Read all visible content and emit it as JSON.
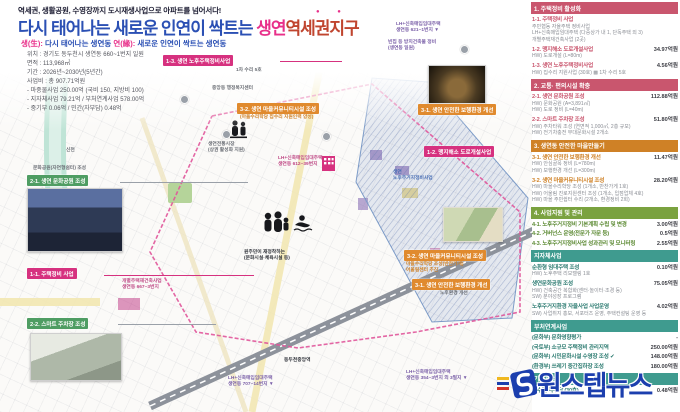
{
  "colors": {
    "title_blue": "#2b50b4",
    "title_pink": "#e8308a",
    "title_red": "#c0452f",
    "label_pink": "#d6317f",
    "label_orange": "#e08a2e",
    "label_green": "#4f9d63",
    "header_pink": "#c9566e",
    "header_orange": "#cf8126",
    "header_green": "#7aa23f",
    "header_teal": "#3f9b8f",
    "watermark_blue": "#1c3fae",
    "zone_blue": "#7d9cc8",
    "boundary_pink": "#e0559a"
  },
  "header": {
    "tagline": "역세권, 생활공원, 수영장까지 도시재생사업으로 아파트를 넘어서다!",
    "title_blue": "다시 태어나는 새로운 인연이 싹트는 ",
    "title_pink": "생연",
    "title_red": "역세권지구",
    "emphasis_dots": "● ●",
    "sub_saeng_label": "생(生):",
    "sub_saeng_text": " 다시 태어나는 생연동   ",
    "sub_yeon_label": "연(緣):",
    "sub_yeon_text": " 새로운 인연이 싹트는 생연동",
    "info": "위치 : 경기도 동두천시 생연동 660~1번지 일원\n면적 : 113,968㎡\n기간 : 2026년~2030년(5년간)\n사업비 : 총 907.71억원\n- 마중물사업 250.00억 (국비 150, 지방비 100)\n- 지자체사업 79.21억 / 부처연계사업 578.00억\n- 중기부 0.06억 / 민간(자부담) 0.48억"
  },
  "map": {
    "label_1_3": "1-3. 생연 노후주택정비사업",
    "label_1_3_sub": "1차 수리 5호",
    "admin_center": "중앙동 행정복지센터",
    "label_3_2_top": "3-2. 생연 마을커뮤니티시설 조성",
    "label_3_2_top_sub": "(마을수리학당 집수리 지원인력 양성)",
    "label_3_1_photo": "3-1. 생연 안전한 보행환경 개선",
    "label_1_2": "1-2. 맹지해소 도로개설사업",
    "label_3_2_low": "3-2. 생연 마을커뮤니티시설 조성",
    "label_3_2_low_sub": "마을수리학당 조성(반찬가게)\n어울림센터 추진",
    "label_3_1_low": "3-1. 생연 안전한 보행환경 개선",
    "label_3_1_low_sub": "노후환경 개선",
    "label_2_1": "2-1. 생연 문화공원 조성",
    "label_2_1_above": "문화공원(자연형쉼터) 조성",
    "label_1_1": "1-1. 주택정비 사업",
    "label_1_1_note": "개별주택재건축사업\n생연동 667~3번지",
    "label_2_2": "2-2. 스마트 주차장 조성",
    "lh_pin_1": "LH+신축매입임대주택\n생연동 621~1번지 ▼",
    "lh_pin_2": "LH+신축매입임대주택\n생연동 612~39번지",
    "lh_pin_3": "LH+신축매입임대주택\n생연동 707~14번지 ▼",
    "lh_pin_4": "LH+신축매입임대주택\n생연동 354~3번지 외 3필지 ▼",
    "vacant_note": "빈집 등 방치건축물 정비\n(생연동 일원)",
    "zone_text": "생연\n노후주거지정비사업",
    "center_caption": "원주민이 재정착하는\n(문화시설·체육시설 등)",
    "market_caption": "생연전통시장\n(상권 활성화 지원)",
    "station": "동두천중앙역",
    "stream": "신천"
  },
  "legend": {
    "sections": [
      {
        "header": "1. 주택정비 활성화",
        "items": [
          {
            "title": "1-1. 주택정비 사업",
            "amount": "",
            "subs": "주민협동 자율주택 정비사업\nLH+신축매입임대주택 (다중상가 내 1, 단독주택 외 3)\n개별주택재건축사업 (2곳)"
          },
          {
            "title": "1-2. 맹지해소 도로개설사업",
            "amount": "34.97억원",
            "subs": "HW) 도로개설 (L=80m)"
          },
          {
            "title": "1-3. 생연 노후주택정비사업",
            "amount": "4.56억원",
            "subs": "HW) 집수리 지원사업 (30호)  ▩ 1차 수리 5호"
          }
        ]
      },
      {
        "header": "2. 교통· 편의시설 확충",
        "items": [
          {
            "title": "2-1. 생연 문화공원 조성",
            "amount": "112.88억원",
            "subs": "HW) 문화공원 (A=3,891㎡)\nHW) 도로 정비 (L=40m)"
          },
          {
            "title": "2-2. 스마트 주차장 조성",
            "amount": "51.80억원",
            "subs": "HW) 주차타워 조성 (연면적 1,000㎡, 2층 규모)\nHW) 전기차충전 부대문화시설 2개소"
          }
        ]
      },
      {
        "header": "3. 생연동 안전한 마을만들기",
        "items": [
          {
            "title": "3-1. 생연 안전한 보행환경 개선",
            "amount": "11.47억원",
            "subs": "HW) 안심골목 정비 (L=780m)\nHW) 보행환경 개선 (L=300m)"
          },
          {
            "title": "3-2. 생연 마을커뮤니티시설 조성",
            "amount": "28.20억원",
            "subs": "HW) 마을수리학당 조성 (1개소, 반찬가게 1호)\nHW) 어울림 진로지원센터 조성 (1개소, 입점업체 4호)\nHW) 마을 주민쉼터 수리 (2개소, 환경정비 2회)"
          }
        ]
      },
      {
        "header": "4. 사업지원 및 관리",
        "items": [
          {
            "title": "4-1. 노후주거지정비 기본계획 수립 및 변경",
            "amount": "3.00억원",
            "subs": ""
          },
          {
            "title": "4-2. 거버넌스 운영(전문가 자문 등)",
            "amount": "0.5억원",
            "subs": ""
          },
          {
            "title": "4-3. 노후주거지정비사업 성과관리 및 모니터링",
            "amount": "2.55억원",
            "subs": ""
          }
        ]
      },
      {
        "header": "지자체사업",
        "items": [
          {
            "title": "순환형 임대주택 조성",
            "amount": "0.10억원",
            "subs": "HW) 노후주택 리모델링 1호"
          },
          {
            "title": "생연문화공원 조성",
            "amount": "75.05억원",
            "subs": "HW) 건축공간 복합화(센터·놀이터·조경 등)\nSW) 분야성장 프로그램"
          },
          {
            "title": "노후주거지환경 자율사업 사업운영",
            "amount": "4.02억원",
            "subs": "SW) 사업취지 홍보, 서포터즈 운영, 주택컨설팅 운영 등"
          }
        ]
      },
      {
        "header": "부처연계사업",
        "items": [
          {
            "title": "(문화부) 문화영향평가",
            "amount": "-",
            "subs": ""
          },
          {
            "title": "(국토부) 소규모 주택정비 관리지역",
            "amount": "250.00억원",
            "subs": ""
          },
          {
            "title": "(문화부) 시민문화시설 수영장 조성 ✔",
            "amount": "148.00억원",
            "subs": ""
          },
          {
            "title": "(환경부) 쓰레기 중간집하장 조성",
            "amount": "180.00억원",
            "subs": ""
          }
        ]
      },
      {
        "header": "기타사업",
        "items": [
          {
            "title": "집수리 자부담 (30호)",
            "amount": "0.48억원",
            "subs": ""
          }
        ]
      }
    ]
  },
  "watermark": {
    "text": "원스텝뉴스"
  }
}
